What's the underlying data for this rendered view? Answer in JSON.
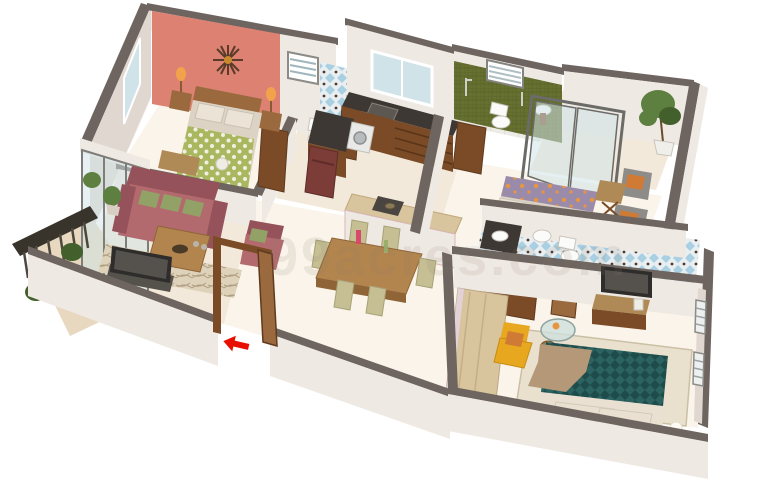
{
  "scene": {
    "type": "3d-isometric-floor-plan-render",
    "watermark": "99acres.com",
    "entrance_marker": "red-arrow"
  },
  "rooms": [
    {
      "name": "bedroom-1",
      "items": [
        "double-bed-green-polka-duvet",
        "headboard",
        "two-nightstands",
        "two-orange-lamps",
        "sunburst-wall-clock",
        "coral-accent-wall",
        "window",
        "foot-bench"
      ]
    },
    {
      "name": "bathroom-1",
      "items": [
        "blue-diamond-tile-wall",
        "louver-window",
        "toilet",
        "wash-basin",
        "wood-door"
      ]
    },
    {
      "name": "kitchen",
      "items": [
        "window",
        "dark-granite-counter",
        "sink",
        "wood-cabinets",
        "maroon-refrigerator",
        "washing-machine",
        "breakfast-bar"
      ]
    },
    {
      "name": "bathroom-2",
      "items": [
        "olive-green-tile-wall",
        "louver-window",
        "shower",
        "toilet",
        "wash-basin"
      ]
    },
    {
      "name": "rear-balcony",
      "items": [
        "sliding-glass-door",
        "potted-tree"
      ]
    },
    {
      "name": "bedroom-2",
      "items": [
        "bed-purple-orange-cover",
        "two-grey-armchairs",
        "orange-cushions",
        "folding-side-table",
        "wood-door"
      ]
    },
    {
      "name": "bathroom-3",
      "items": [
        "blue-pattern-tile-floor",
        "counter-basin",
        "wash-basin",
        "toilet"
      ]
    },
    {
      "name": "master-bedroom",
      "items": [
        "teal-pattern-bed",
        "tan-throw",
        "cream-pillows",
        "yellow-armchair",
        "round-glass-table",
        "wall-tv",
        "wood-tv-console",
        "long-wardrobe",
        "slat-windows",
        "rug",
        "ball-lamps"
      ]
    },
    {
      "name": "living-room",
      "items": [
        "rose-three-seat-sofa",
        "green-cushions",
        "rose-armchair",
        "wood-coffee-table",
        "tv-on-cabinet",
        "patterned-rug",
        "potted-plant",
        "sliding-glass-wall"
      ]
    },
    {
      "name": "dining-area",
      "items": [
        "wood-dining-table",
        "six-olive-chairs",
        "vases"
      ]
    },
    {
      "name": "left-balcony",
      "items": [
        "dark-railing",
        "planter-plants"
      ]
    },
    {
      "name": "entrance",
      "items": [
        "open-wood-door",
        "red-entry-arrow"
      ]
    }
  ],
  "colors": {
    "floor": "#f3e9da",
    "floorLight": "#faf4ea",
    "floorBalcony": "#e7d8bf",
    "floorTile": "#edebe6",
    "wall": "#efe9e3",
    "wallShade": "#e0d8d0",
    "cap": "#6e6560",
    "coral": "#dd8172",
    "coralDark": "#c96e62",
    "glass": "#cfe3e8",
    "glassFrame": "#7d7d7a",
    "wood": "#9a6a3e",
    "woodDark": "#7a4b26",
    "woodLight": "#d8c49d",
    "woodMid": "#b08a56",
    "counterDark": "#3d3833",
    "fridge": "#7c3c38",
    "fixture": "#fbfbf9",
    "tileBlue": "#a9cfe2",
    "tileBlueDark": "#4a3a30",
    "tileGreen": "#66702f",
    "tileGreenDark": "#4f5922",
    "duvetGreen": "#a9b85f",
    "bedCream": "#ddd3c4",
    "pillow": "#eae3d6",
    "sofaRose": "#b26a6e",
    "sofaRoseDark": "#96525a",
    "cushionGreen": "#92a266",
    "chairOlive": "#c5bf93",
    "tableWood": "#b3854e",
    "bedPurple": "#9b8bab",
    "floralOrange": "#e8953f",
    "armchairGrey": "#8d8c88",
    "bedTeal": "#2c6260",
    "bedTealDark": "#1e4c4b",
    "throwTan": "#b49878",
    "pillowCream": "#e9e0d2",
    "chairYellow": "#e7a71e",
    "cushionOrange": "#cf7a35",
    "plant": "#5d7f3f",
    "plantDark": "#43602c",
    "railing": "#38342c",
    "rug": "#ded2ba",
    "rugLine": "#b09f82",
    "tvDark": "#2e2d2b",
    "tvScreen": "#55524e",
    "arrowRed": "#e80f00",
    "watermark": "#8a7a6a",
    "lampOrange": "#f2a24b",
    "tableGlass": "#cfe0dd"
  }
}
